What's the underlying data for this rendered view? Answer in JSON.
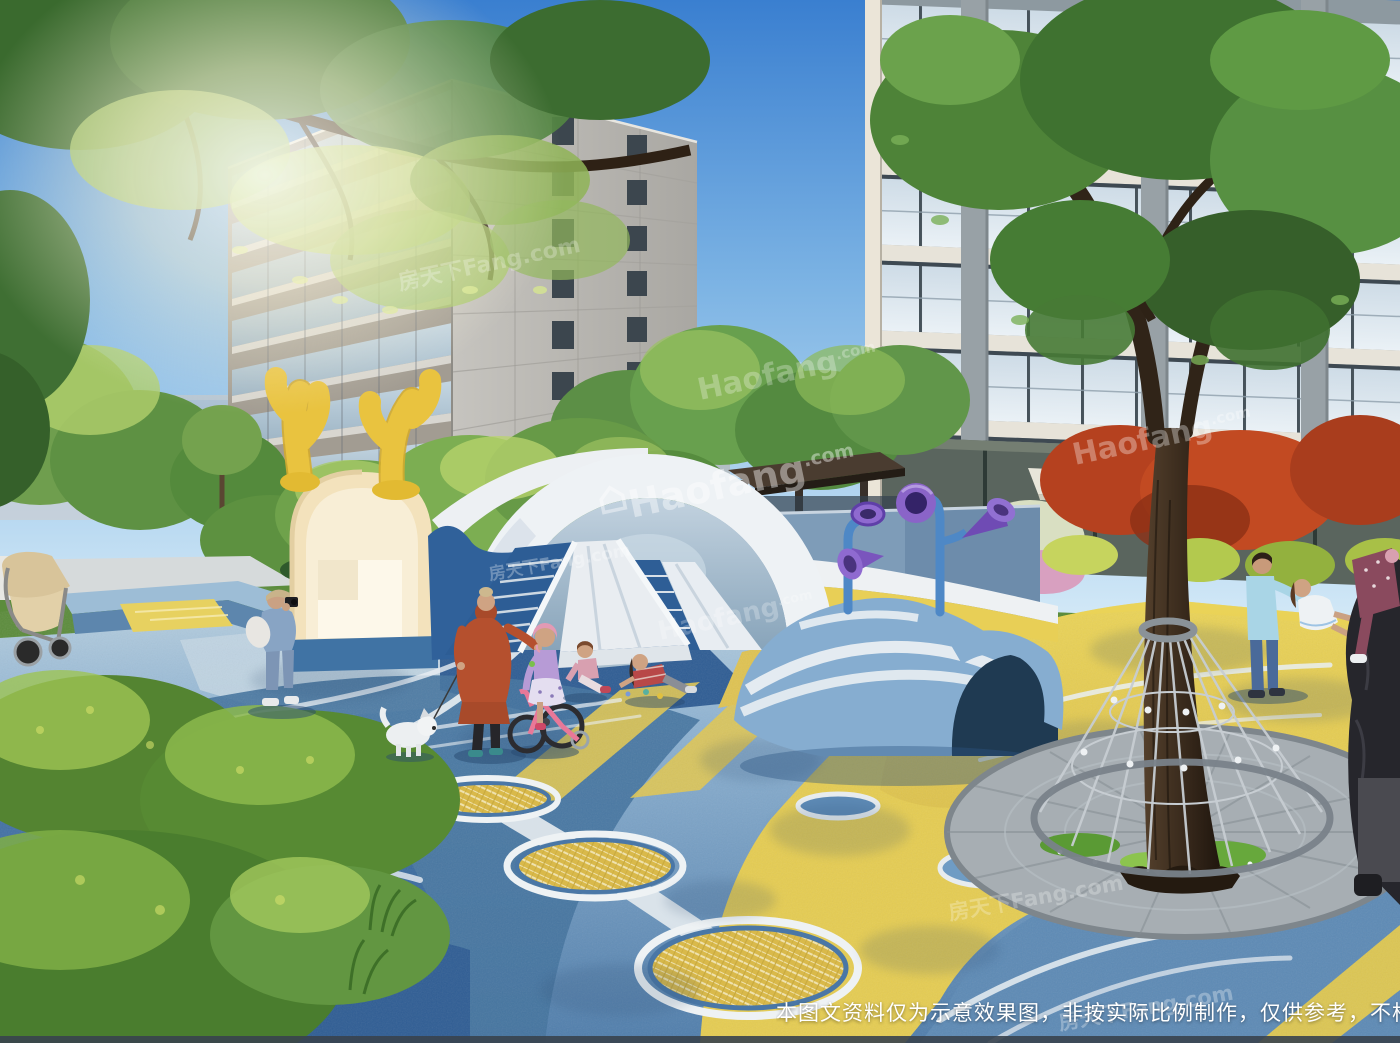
{
  "meta": {
    "type": "architectural-rendering",
    "scene": "residential community children's playground"
  },
  "watermarks": {
    "haofang": "Haofang",
    "haofang_suffix": ".com",
    "fangtianxia": "房天下Fang.com"
  },
  "disclaimer": {
    "text": "本图文资料仅为示意效果图，非按实际比例制作，仅供参考，不构成开"
  },
  "palette": {
    "sky_top": "#3a7fd0",
    "sky_horizon": "#d8ecf8",
    "surface_light_blue": "#8fb6d4",
    "surface_deep_blue": "#2d5d95",
    "path_yellow": "#e5cc52",
    "tunnel_white": "#eef2f5",
    "pavilion_cream": "#f3e2bc",
    "antler_yellow": "#e9c33f",
    "trumpet_purple": "#7a55bd",
    "mound_blue": "#86add0",
    "foliage_green": "#4e8338",
    "maple_red": "#b5411f"
  }
}
